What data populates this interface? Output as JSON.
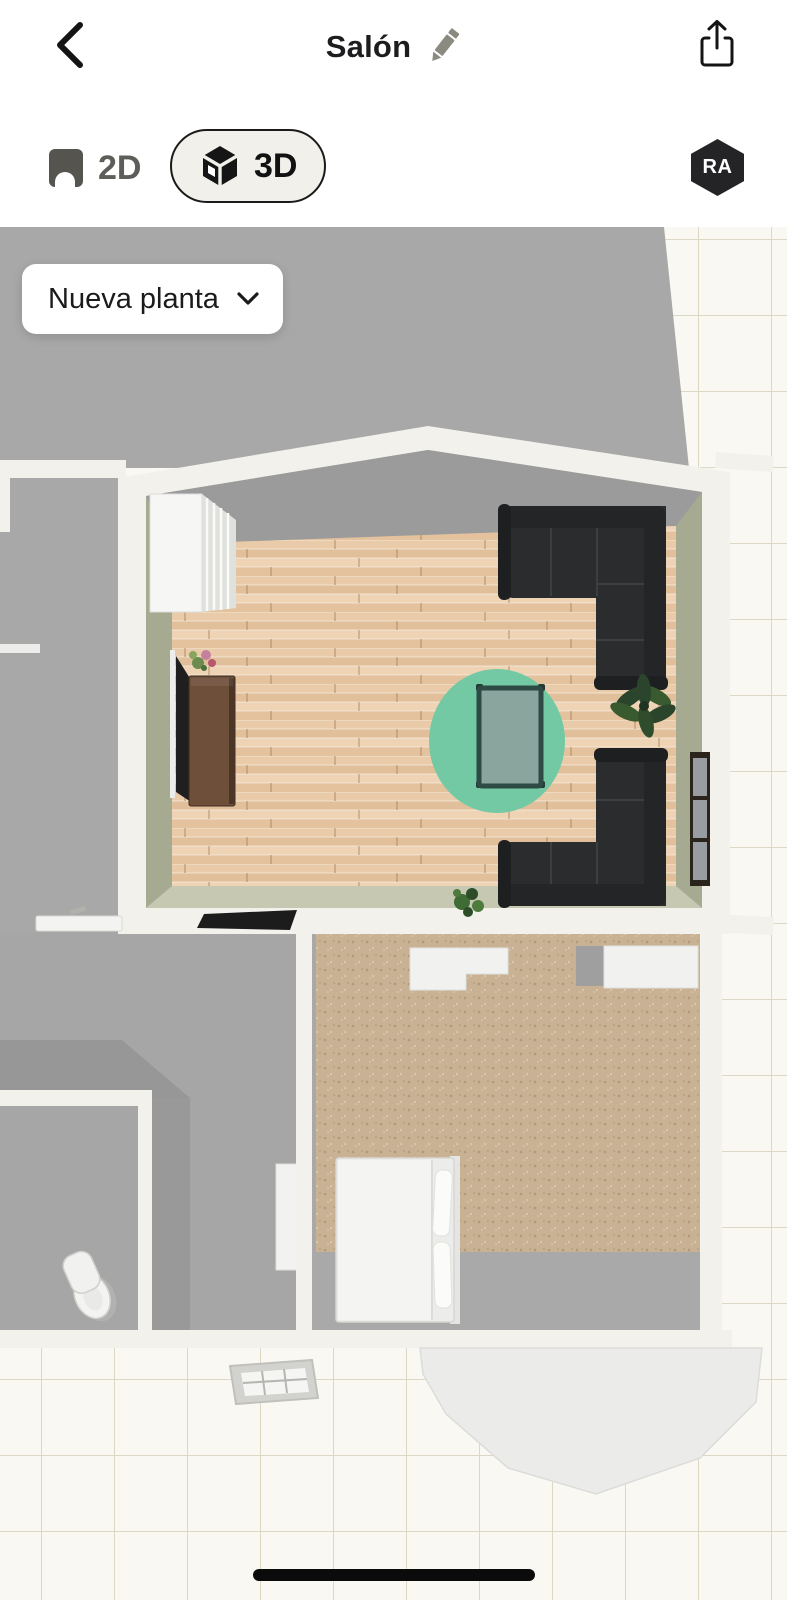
{
  "header": {
    "title": "Salón",
    "back_icon": "chevron-left-icon",
    "edit_icon": "pencil-icon",
    "share_icon": "share-icon"
  },
  "view_toggle": {
    "options": [
      {
        "id": "2d",
        "label": "2D",
        "icon": "floorplan-2d-icon",
        "active": false
      },
      {
        "id": "3d",
        "label": "3D",
        "icon": "cube-3d-icon",
        "active": true
      }
    ],
    "ar_badge_label": "RA"
  },
  "floor_selector": {
    "label": "Nueva planta",
    "icon": "chevron-down-icon"
  },
  "scene": {
    "type": "floorplan-3d-render",
    "active_room": "salon",
    "visible_rooms": [
      "salon",
      "bedroom",
      "hallway",
      "bathroom",
      "neighbor-room"
    ],
    "visible_furniture": [
      "bookshelf",
      "tv",
      "tv-sideboard",
      "flower-vase",
      "round-rug",
      "coffee-table",
      "corner-sofa-north",
      "corner-sofa-south",
      "monstera-plant",
      "wall-mirror",
      "door-mat",
      "floor-plant",
      "wardrobes",
      "bed",
      "pillows",
      "hall-door",
      "toilet",
      "wall-sink",
      "skylight",
      "bay-window"
    ]
  },
  "colors": {
    "header_bg": "#ffffff",
    "header_text": "#1d1d1f",
    "muted_icon": "#8a8a80",
    "toggle_active_bg": "#f1f0ea",
    "toggle_border": "#1a1a1a",
    "toggle_inactive": "#5d5d59",
    "ar_badge_bg": "#242427",
    "ar_badge_text": "#ffffff",
    "dropdown_bg": "#ffffff",
    "dropdown_text": "#1b1b1b",
    "tile_bg": "#faf8f2",
    "tile_line": "#ddd8c3",
    "neighbor_floor": "#a8a8a8",
    "wall_white": "#f3f1ec",
    "wall_olive": "#a6aa91",
    "wall_olive_light": "#c6c8b1",
    "wall_shadow": "#9b9b9b",
    "wood_base": "#e6c5a2",
    "rug": "#74c9a5",
    "table_frame": "#2e4a44",
    "table_glass": "#8aa49e",
    "sofa": "#2a2c2e",
    "sofa_dark": "#232527",
    "sideboard": "#6d4f3a",
    "tv": "#1f1f1f",
    "carpet": "#c9b193",
    "bed": "#ececea",
    "fixture_white": "#f3f3f1",
    "bay": "#ebebe9",
    "home_indicator": "#0b0b0b"
  }
}
